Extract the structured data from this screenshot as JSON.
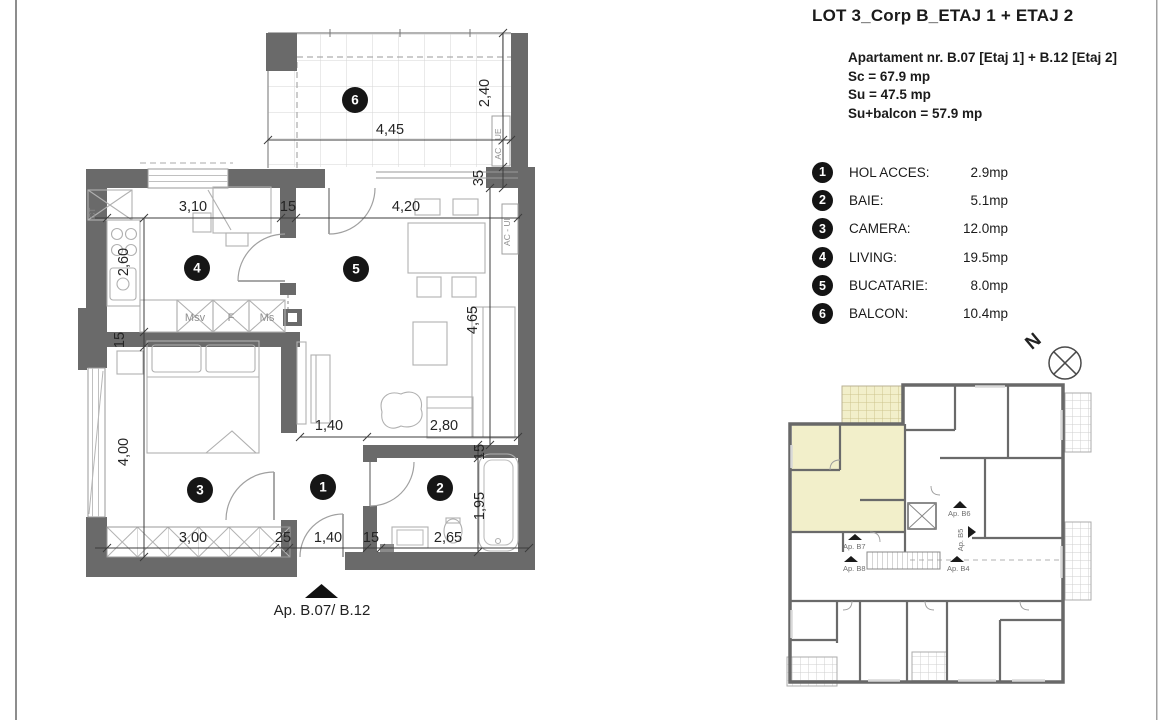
{
  "header": {
    "title": "LOT 3_Corp B_ETAJ 1 + ETAJ 2"
  },
  "apartment_info": {
    "name": "Apartament nr. B.07 [Etaj 1] + B.12  [Etaj 2]",
    "sc": "Sc = 67.9 mp",
    "su": "Su = 47.5 mp",
    "su_balcon": "Su+balcon = 57.9 mp"
  },
  "legend": {
    "items": [
      {
        "num": "1",
        "label": "HOL ACCES:",
        "area": "2.9mp"
      },
      {
        "num": "2",
        "label": "BAIE:",
        "area": "5.1mp"
      },
      {
        "num": "3",
        "label": "CAMERA:",
        "area": "12.0mp"
      },
      {
        "num": "4",
        "label": "LIVING:",
        "area": "19.5mp"
      },
      {
        "num": "5",
        "label": "BUCATARIE:",
        "area": "8.0mp"
      },
      {
        "num": "6",
        "label": "BALCON:",
        "area": "10.4mp"
      }
    ]
  },
  "plan": {
    "entrance_label": "Ap. B.07/ B.12",
    "rooms": {
      "r1": "1",
      "r2": "2",
      "r3": "3",
      "r4": "4",
      "r5": "5",
      "r6": "6"
    },
    "dims": {
      "balcony_width": "4,45",
      "balcony_depth": "2,40",
      "wall_step": "35",
      "kitchen_width": "3,10",
      "wall_top": "15",
      "living_width": "4,20",
      "kitchen_depth": "2,60",
      "wall_left": "15",
      "living_depth": "4,65",
      "bedroom_depth": "4,00",
      "hall_width": "1,40",
      "living_bottom": "2,80",
      "bath_wall": "15",
      "bath_depth": "1,95",
      "bedroom_width": "3,00",
      "wall_bottom": "25",
      "hall_bottom": "1,40",
      "bath_wall_bottom": "15",
      "bath_width": "2,65"
    },
    "labels": {
      "ct": "CT",
      "msv": "Msv",
      "f": "F",
      "ms": "Ms",
      "ac_ue": "AC - UE",
      "ac_ui": "AC - UI"
    }
  },
  "north": {
    "label": "N"
  },
  "keyplan": {
    "labels": {
      "b7": "Ap. B7",
      "b8": "Ap. B8",
      "b6": "Ap. B6",
      "b5": "Ap. B5",
      "b4": "Ap. B4"
    },
    "highlight_color": "#f2efca"
  },
  "colors": {
    "wall": "#6a6a6a",
    "highlight": "#f2efca",
    "hatch": "#d6d6d6"
  }
}
